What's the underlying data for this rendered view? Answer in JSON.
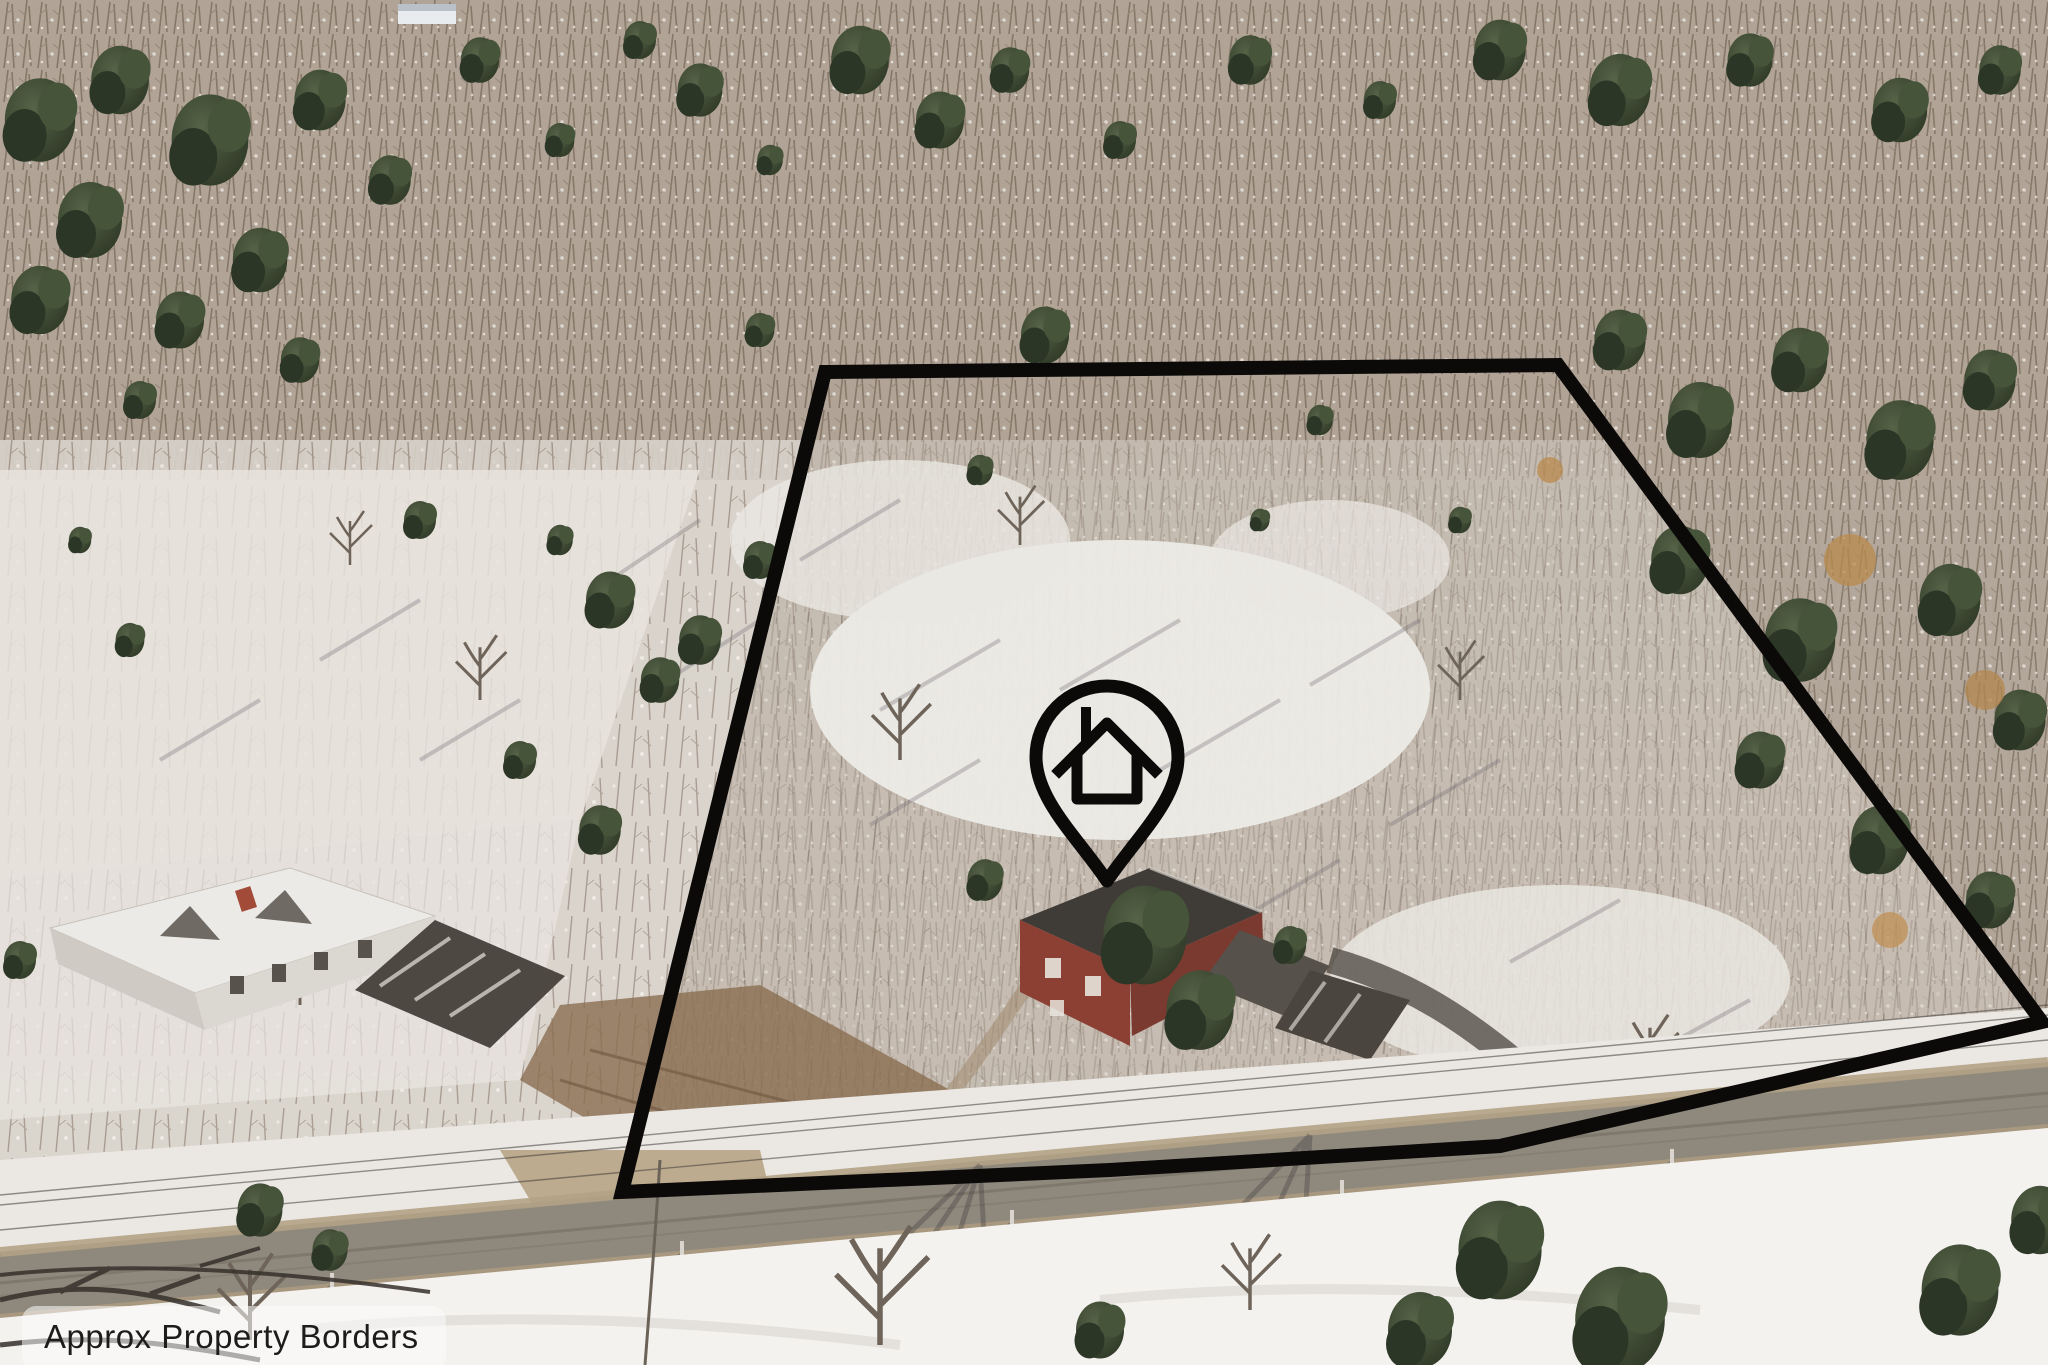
{
  "overlay": {
    "label": {
      "text": "Approx Property Borders",
      "text_color": "#1d1c1a",
      "bg_color": "rgba(252,252,252,0.55)"
    },
    "property_border": {
      "points": "825,372 1558,365 2042,1022 1500,1146 1110,1170 622,1192",
      "color": "#0b0a09",
      "stroke_width": "14"
    },
    "pin": {
      "icon_name": "house-location-pin-icon",
      "color": "#0b0a09"
    }
  },
  "photo": {
    "colors": {
      "snow": "#efedea",
      "bare_forest": "#a99c8f",
      "evergreen": "#35402d",
      "road": "#8f897d",
      "road_shoulder": "#b3a285",
      "dirt_leaves": "#8a6e51",
      "brick_house": "#8c4034",
      "dark_roof": "#3f3b36",
      "neighbor_roof_snow": "#eceae6"
    }
  }
}
